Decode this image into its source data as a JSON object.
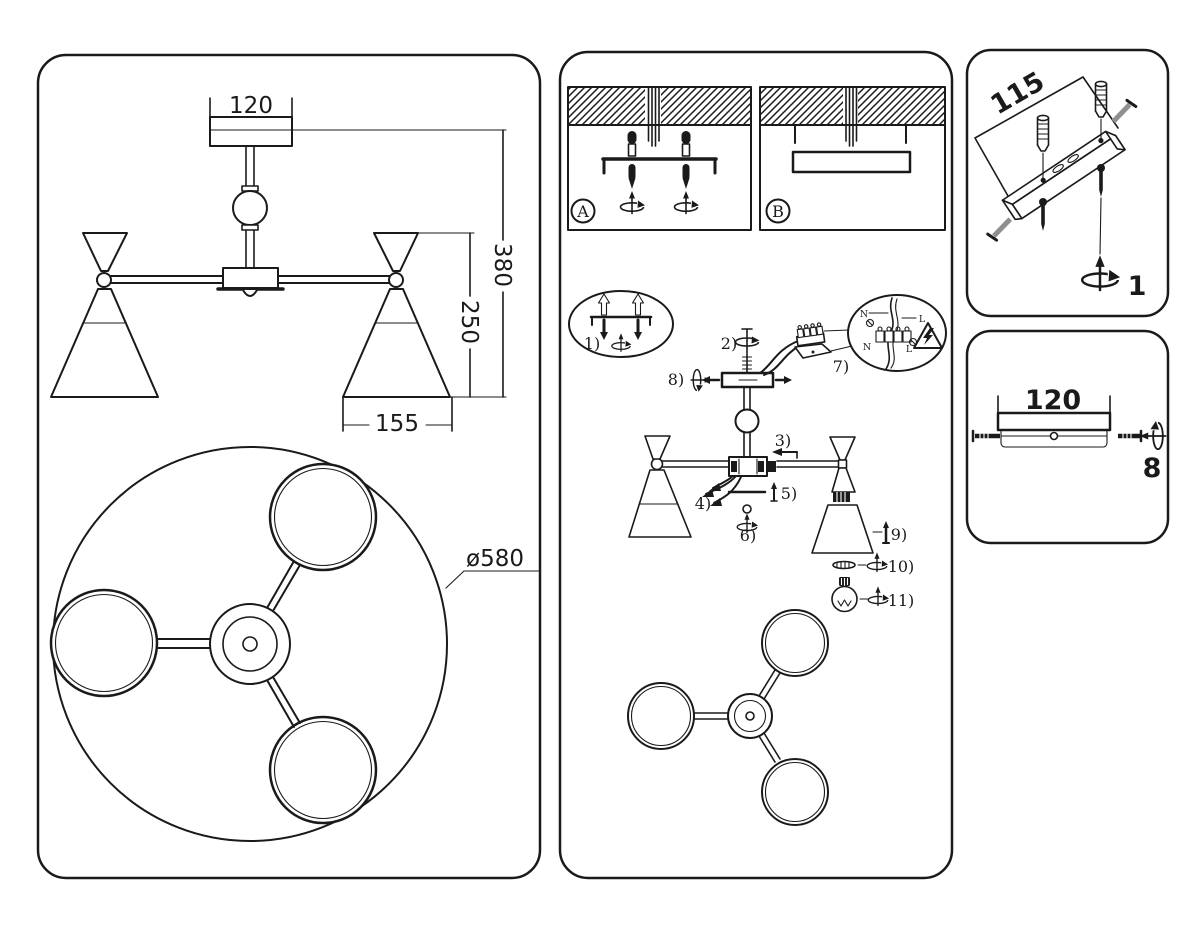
{
  "colors": {
    "ink": "#1a1a1a",
    "paper": "#ffffff",
    "screw_gray": "#8f8f8f"
  },
  "icons": {
    "rotation": "screw-rotation-icon",
    "warning": "electric-shock-warning-icon"
  },
  "left_panel": {
    "front_view": {
      "canopy_width": "120",
      "total_height": "380",
      "shade_drop": "250",
      "shade_width": "155"
    },
    "bottom_view": {
      "diameter": "ø580"
    }
  },
  "middle_panel": {
    "mount_option_a": "A",
    "mount_option_b": "B",
    "steps": {
      "s1": "1)",
      "s2": "2)",
      "s3": "3)",
      "s4": "4)",
      "s5": "5)",
      "s6": "6)",
      "s7": "7)",
      "s8": "8)",
      "s9": "9)",
      "s10": "10)",
      "s11": "11)"
    },
    "wiring": {
      "n_top": "N",
      "l_top": "L",
      "n_bottom": "N",
      "l_bottom": "L"
    }
  },
  "bracket_panel": {
    "length": "115",
    "qty": "1"
  },
  "canopy_panel": {
    "length": "120",
    "qty": "8"
  }
}
